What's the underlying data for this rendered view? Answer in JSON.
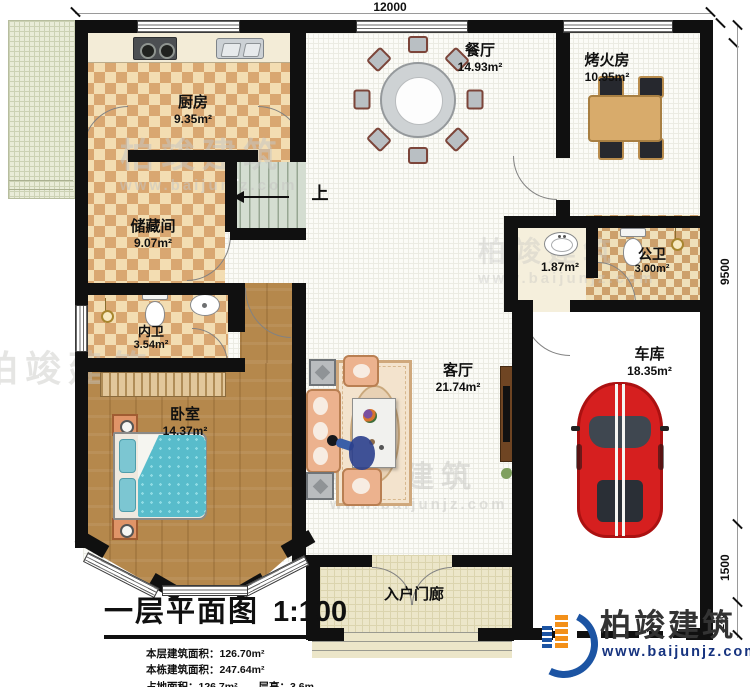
{
  "plan": {
    "dimensions": {
      "top": "12000",
      "right_upper": "9500",
      "right_lower": "1500",
      "right_bottom": "240"
    },
    "rooms": {
      "kitchen": {
        "name": "厨房",
        "area": "9.35m²"
      },
      "dining": {
        "name": "餐厅",
        "area": "14.93m²"
      },
      "fire_room": {
        "name": "烤火房",
        "area": "10.95m²"
      },
      "storage": {
        "name": "储藏间",
        "area": "9.07m²"
      },
      "inner_bath": {
        "name": "内卫",
        "area": "3.54m²"
      },
      "bedroom": {
        "name": "卧室",
        "area": "14.37m²"
      },
      "living": {
        "name": "客厅",
        "area": "21.74m²"
      },
      "wash_area": {
        "area": "1.87m²"
      },
      "public_bath": {
        "name": "公卫",
        "area": "3.00m²"
      },
      "garage": {
        "name": "车库",
        "area": "18.35m²"
      },
      "porch": {
        "name": "入户门廊"
      }
    },
    "stairs": {
      "up_label": "上"
    }
  },
  "title_block": {
    "title": "一层平面图",
    "scale": "1:100",
    "info_lines": [
      "本层建筑面积：126.70m²",
      "本栋建筑面积：247.64m²",
      "占地面积：126.7m²",
      "层高：3.6m"
    ]
  },
  "branding": {
    "company": "柏竣建筑",
    "website": "www.baijunjz.com"
  },
  "colors": {
    "wall": "#101010",
    "checker_tan": "#d9a771",
    "wood": "#b5884c",
    "bed_teal": "#58bccb",
    "sofa_peach": "#ecb28e",
    "car_red": "#d61f1f",
    "stair_green": "#d4ddd1",
    "logo_blue": "#1c54a3",
    "logo_orange": "#f39019"
  }
}
